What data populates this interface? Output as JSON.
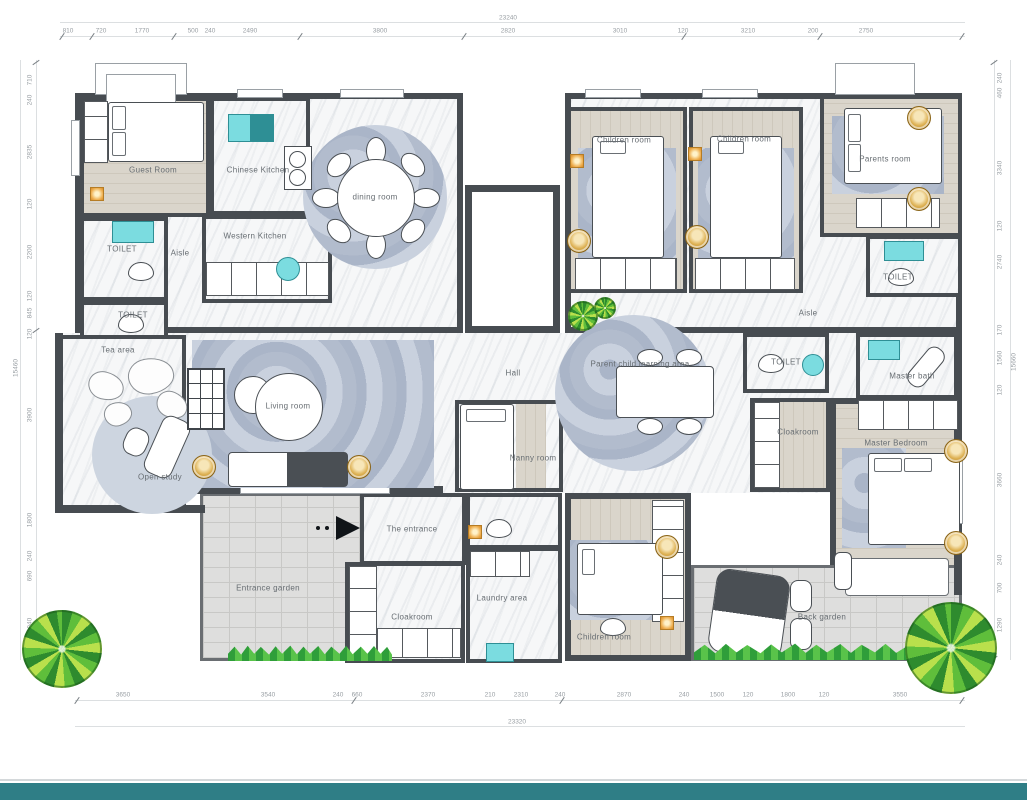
{
  "doc": {
    "type": "residential floor plan"
  },
  "colors": {
    "wall": "#474c51",
    "marble_floor": "#f6f7f8",
    "wood_floor": "#d6d1c6",
    "rug_blue": "#b7c1d2",
    "sink_teal": "#7bdce0",
    "lamp_gold": "#ddb052",
    "accent_orange": "#eeae4e",
    "grass_green": "#3fae3f",
    "paving_gray": "#dededd",
    "footer_teal": "#2f7e86",
    "dim_text": "#989ea3",
    "label_text": "#676d72"
  },
  "rooms": {
    "guest_room": "Guest Room",
    "chinese_kitchen": "Chinese Kitchen",
    "toilet_a": "TOILET",
    "toilet_b": "TOILET",
    "aisle_left": "Aisle",
    "western_kitchen": "Western Kitchen",
    "dining_room": "dining room",
    "children_room_a": "Children room",
    "children_room_b": "Children room",
    "parents_room": "Parents room",
    "toilet_top_right": "TOILET",
    "aisle_right": "Aisle",
    "tea_area": "Tea area",
    "open_study": "Open study",
    "living_room": "Living room",
    "hall": "Hall",
    "learning_area": "Parent child learning area",
    "nanny_room": "Nanny room",
    "toilet_mid": "TOILET",
    "master_bath": "Master bath",
    "cloakroom_right": "Cloakroom",
    "master_bedroom": "Master Bedroom",
    "the_entrance": "The entrance",
    "entrance_garden": "Entrance garden",
    "cloakroom_bottom": "Cloakroom",
    "laundry_area": "Laundry area",
    "children_room_c": "Children room",
    "back_garden": "Back garden"
  },
  "dims": {
    "top": {
      "total": "23240",
      "segments": [
        "810",
        "720",
        "1770",
        "500",
        "240",
        "2490",
        "3800",
        "2820",
        "3010",
        "120",
        "3210",
        "200",
        "2750"
      ]
    },
    "bottom": {
      "total": "23320",
      "segments": [
        "3650",
        "3540",
        "240",
        "660",
        "2370",
        "210",
        "2310",
        "240",
        "2870",
        "240",
        "1500",
        "120",
        "1800",
        "120",
        "3550"
      ]
    },
    "left": {
      "total": "15460",
      "segments": [
        "710",
        "240",
        "2835",
        "120",
        "2200",
        "120",
        "845",
        "120",
        "3900",
        "1800",
        "240",
        "690",
        "1940"
      ]
    },
    "right": {
      "total": "15660",
      "segments": [
        "240",
        "460",
        "3340",
        "120",
        "2740",
        "170",
        "1560",
        "120",
        "3660",
        "240",
        "700",
        "1290"
      ]
    }
  }
}
